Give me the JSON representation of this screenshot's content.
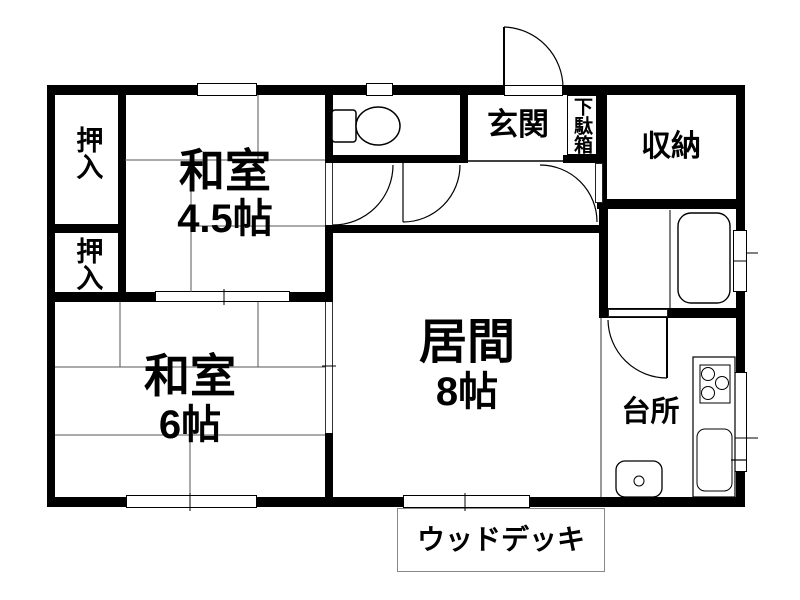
{
  "plan": {
    "title": "apartment-floor-plan",
    "rooms": [
      {
        "id": "washitsu-4_5",
        "label": "和室",
        "size": "4.5帖"
      },
      {
        "id": "washitsu-6",
        "label": "和室",
        "size": "6帖"
      },
      {
        "id": "ima",
        "label": "居間",
        "size": "8帖"
      },
      {
        "id": "genkan",
        "label": "玄関"
      },
      {
        "id": "getabako",
        "label": "下駄箱"
      },
      {
        "id": "shunou",
        "label": "収納"
      },
      {
        "id": "daidokoro",
        "label": "台所"
      },
      {
        "id": "oshiire-upper",
        "label": "押入"
      },
      {
        "id": "oshiire-lower",
        "label": "押入"
      },
      {
        "id": "wood-deck",
        "label": "ウッドデッキ"
      }
    ],
    "fixtures": [
      "toilet-icon",
      "bathtub-icon",
      "kitchen-counter-icon",
      "stove-icon",
      "sink-icon",
      "washbasin-icon",
      "door-swing-arcs",
      "sliding-door-symbols",
      "window-symbols",
      "tatami-lines"
    ],
    "colors": {
      "wall": "#000000",
      "thin_line": "#444444",
      "tatami_line": "#555555",
      "deck_border": "#888888",
      "background": "#ffffff"
    }
  }
}
